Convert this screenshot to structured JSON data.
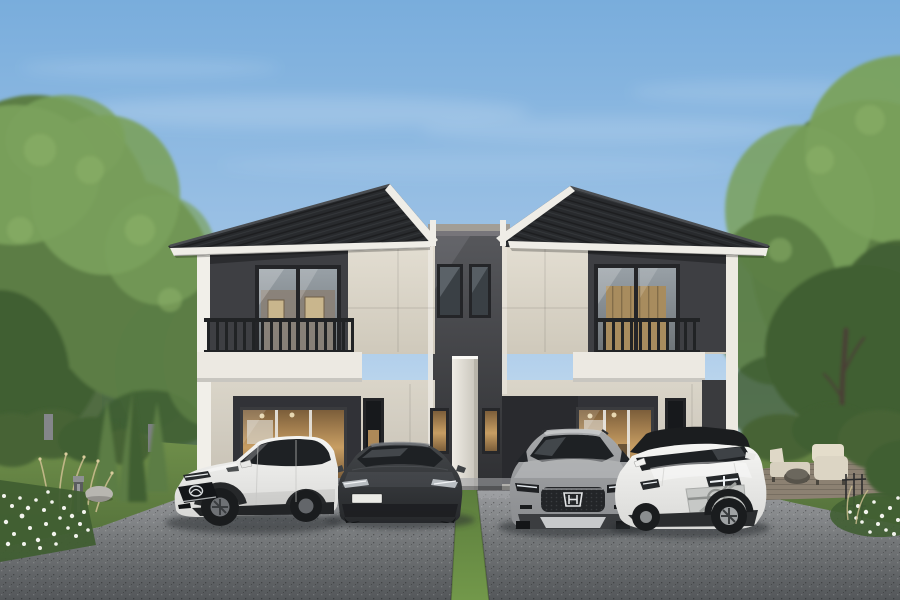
{
  "meta": {
    "type": "architectural-rendering",
    "subject": "Modern two-story twin duplex house with dark tiled gable roofs, cream and charcoal facade, balconies, and four cars parked on the front driveway",
    "time_of_day": "daytime",
    "sky": "clear blue with faint wispy clouds"
  },
  "colors": {
    "sky_top": "#79ADDC",
    "sky_mid": "#A4C6E7",
    "sky_low": "#CFE3F3",
    "sky_horizon": "#E8F1F8",
    "cloud": "#FFFFFF",
    "tree_light": "#7AA15C",
    "tree_mid": "#5B7D45",
    "tree_dark": "#405E32",
    "trunk": "#4A4036",
    "bg_building": "#E7E8E4",
    "bg_building_shade": "#9FA1A3",
    "roof": "#282A2D",
    "roof_ridge": "#4A4D51",
    "fascia": "#EFEDE7",
    "wall_cream": "#E3DED2",
    "wall_cream_dark": "#CFC9BB",
    "wall_dark": "#3E3F43",
    "wall_darker": "#2B2C2F",
    "center_top": "#56575B",
    "center_bottom": "#2E2F32",
    "pillar": "#EFECE5",
    "pillar_shade": "#C6C2B8",
    "slab": "#ECE9E2",
    "railing": "#212325",
    "window_frame": "#242528",
    "glass_top": "#98A0A6",
    "glass_bottom": "#6E7478",
    "interior_light": "#C89E63",
    "interior_dark": "#7C5E3A",
    "interior_wall": "#8A8177",
    "picture": "#C9B68D",
    "road_top": "#9C9EA1",
    "road_mid": "#737678",
    "road_bottom": "#54575A",
    "lawn_light": "#71914B",
    "lawn_dark": "#53703A",
    "hedge": "#466336",
    "flower": "#F3F4EE",
    "grass_tuft": "#C9BC8E",
    "patio": "#8C8172",
    "furniture": "#DCD5C4",
    "rock": "#B8B6B0",
    "strip_top": "#5C7D3D",
    "strip_bottom": "#72984A",
    "car_white": "#F5F5F3",
    "car_white_shade": "#D9D9D7",
    "car_sedan": "#44474A",
    "car_sedan_dark": "#26282B",
    "car_silver": "#A6A8AA",
    "car_silver_dark": "#8A8C8F",
    "car_black_roof": "#1B1D1F",
    "car_window": "#1E2124",
    "tire": "#1A1C1E",
    "chrome": "#D6D8DA",
    "plate": "#EAEAE6",
    "shadow": "#2C2F31"
  },
  "house": {
    "stories": 2,
    "units": [
      {
        "side": "left",
        "features": [
          "dark-tile-gable-roof",
          "white-fascia-trim",
          "recessed-charcoal-balcony",
          "dark-metal-balcony-railing",
          "large-upper-sliding-window-with-framed-pictures",
          "cream-panel-facade",
          "white-corner-pillar",
          "ground-floor-glass-sliding-doors-warm-interior",
          "narrow-dark-side-window"
        ]
      },
      {
        "side": "right",
        "features": [
          "dark-tile-gable-roof",
          "white-fascia-trim",
          "recessed-charcoal-balcony",
          "dark-metal-balcony-railing",
          "large-upper-sliding-window-wood-interior",
          "cream-panel-facade",
          "white-corner-pillar",
          "ground-floor-glass-sliding-doors-warm-interior",
          "narrow-dark-side-window"
        ]
      }
    ],
    "center_link": {
      "features": [
        "recessed-charcoal-link-wall",
        "gray-parapet-cap",
        "two-narrow-upper-windows",
        "white-privacy-fin-wall",
        "two-lit-entry-sidelights",
        "white-downspouts"
      ]
    }
  },
  "vehicles": [
    {
      "position": 1,
      "type": "compact-suv",
      "color": "white",
      "view": "three-quarter-front-left",
      "badge": "mazda-logo",
      "details": [
        "black-grille",
        "black-wheel-arch-cladding",
        "slim-headlights"
      ]
    },
    {
      "position": 2,
      "type": "sedan",
      "color": "dark-gray",
      "view": "front",
      "badge": "none",
      "license_plate": "blank-white",
      "details": [
        "slim-led-headlights",
        "smooth-nose"
      ]
    },
    {
      "position": 3,
      "type": "suv",
      "color": "silver-gray",
      "view": "front",
      "badge": "honda-logo",
      "details": [
        "dark-mesh-grille",
        "chrome-h-emblem",
        "silver-skid-plate",
        "roof-rails"
      ]
    },
    {
      "position": 4,
      "type": "suv",
      "color": "white-with-black-roof",
      "view": "three-quarter-front-right",
      "badge": "volvo-logo",
      "details": [
        "iron-mark-grille-emblem",
        "thor-hammer-drl",
        "black-contrast-roof"
      ]
    }
  ],
  "environment": {
    "left_side": [
      "large-green-trees",
      "white-background-building",
      "patio-umbrella",
      "trimmed-hedge",
      "gray-fence-posts",
      "three-cypress-shrubs",
      "ornamental-grasses",
      "bollard-light",
      "landscape-rock",
      "white-flower-bed"
    ],
    "right_side": [
      "large-green-tree-with-trunk",
      "background-building",
      "trimmed-hedge",
      "wood-deck-patio",
      "outdoor-lounge-furniture",
      "round-side-table",
      "black-trellis",
      "white-flower-bed",
      "grass-tufts"
    ],
    "foreground": [
      "asphalt-driveway",
      "concrete-apron",
      "central-grass-strip",
      "car-shadows"
    ]
  }
}
